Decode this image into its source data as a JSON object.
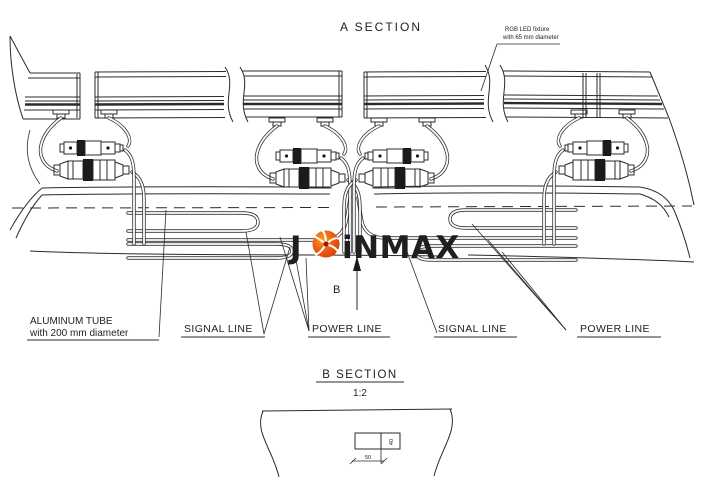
{
  "drawing": {
    "section_a_title": "A SECTION",
    "led_note_line1": "RGB LED fixture",
    "led_note_line2": "with 65 mm diameter",
    "aluminum_label_line1": "ALUMINUM TUBE",
    "aluminum_label_line2": "with 200 mm diameter",
    "signal_line_left": "SIGNAL LINE",
    "power_line_left": "POWER LINE",
    "signal_line_right": "SIGNAL LINE",
    "power_line_right": "POWER LINE",
    "b_marker": "B",
    "section_b_title": "B SECTION",
    "section_b_scale": "1:2",
    "detail_dim_height": "40",
    "detail_dim_width": "50"
  },
  "logo": {
    "part1": "J",
    "part2": "iNMAX",
    "icon_name": "sunburst-icon",
    "text_color": "#4a6480",
    "icon_outer": "#e8491d",
    "icon_inner": "#f7a01e"
  },
  "colors": {
    "ink": "#2b2b2b",
    "paper": "#ffffff"
  }
}
